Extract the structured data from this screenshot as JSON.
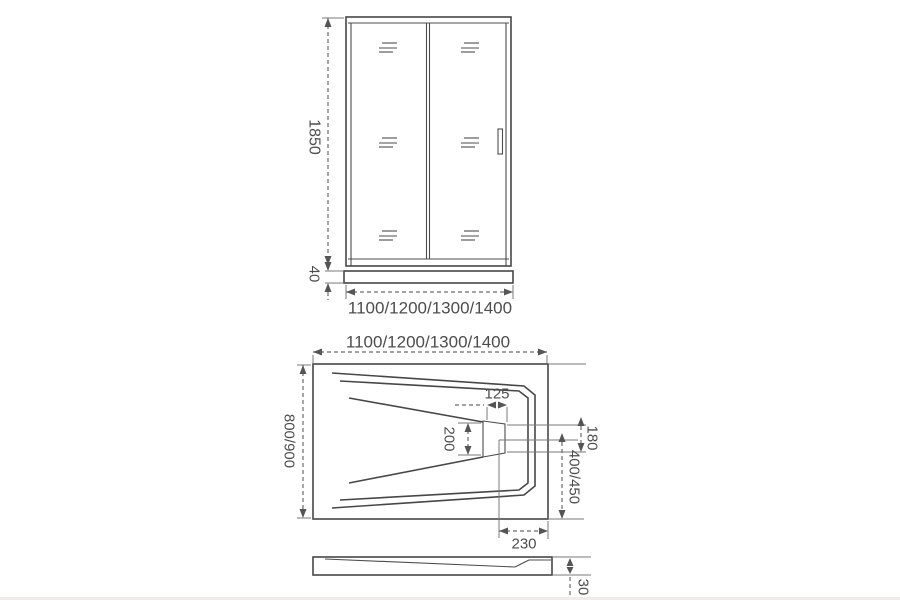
{
  "page": {
    "background": "#ffffff",
    "line_color": "#474747",
    "dim_color": "#6b6b6b",
    "text_color": "#4d4d4d",
    "description": "Technical dimension drawing of sliding shower door and shower tray"
  },
  "views": {
    "front": {
      "title": "front-elevation-of-sliding-door",
      "dims": {
        "height": "1850",
        "base_height": "40",
        "width": "1100/1200/1300/1400"
      }
    },
    "plan": {
      "title": "top-view-of-shower-tray",
      "dims": {
        "width": "1100/1200/1300/1400",
        "depth": "800/900",
        "drain_slot_width": "125",
        "drain_slot_height": "200",
        "drain_edge_offset": "180",
        "drain_back_offset": "400/450",
        "drain_side_offset": "230"
      }
    },
    "profile": {
      "title": "side-profile-of-tray",
      "dims": {
        "height": "30"
      }
    }
  }
}
